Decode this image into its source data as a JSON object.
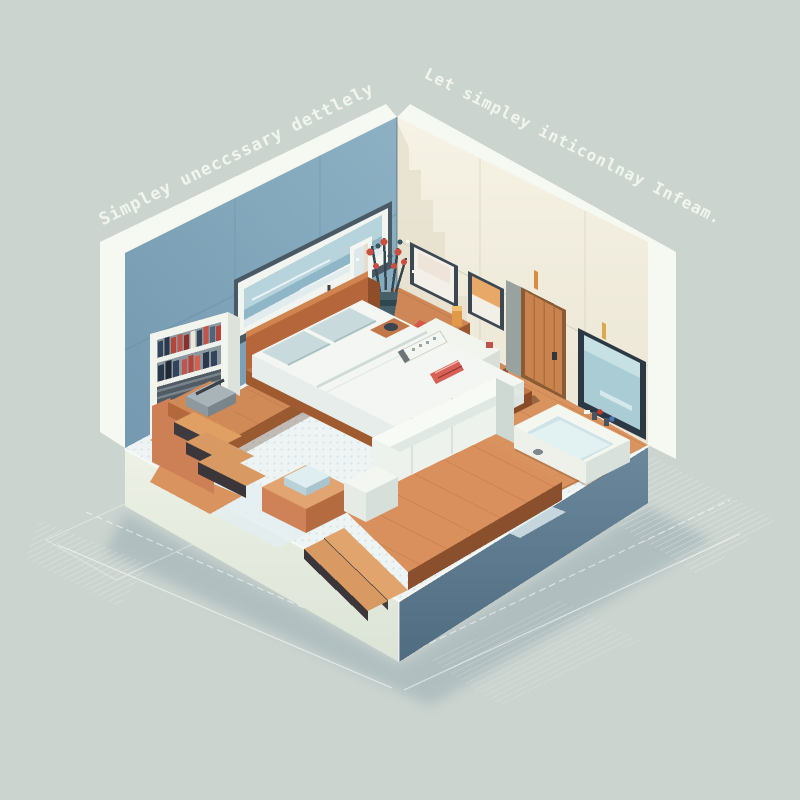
{
  "illustration": {
    "style": "isometric pixel-art bedroom diorama",
    "captions": {
      "left": "Simpley uneccssary dettlely",
      "right": "Let simpley inticonlnay Infeam."
    },
    "palette": {
      "background": "#ccd4cf",
      "left_wall": "#82a8bd",
      "right_wall": "#f3efe2",
      "wall_trim": "#f6f8f2",
      "floor_rug": "#eef3f4",
      "wood": "#d08a57",
      "wood_dark": "#9a5a31",
      "base_front": "#e9eee3",
      "base_side": "#5d7b90",
      "bed_linen": "#f3f6f2",
      "pillow": "#c8dadb",
      "accent_red": "#c4503e",
      "accent_orange": "#e0a46c",
      "tv_screen": "#a9ccd5",
      "caption_text": "#f4f7f0"
    },
    "objects": [
      "bed",
      "pillows",
      "bookshelf",
      "books",
      "stairs",
      "game-console",
      "wall-art",
      "mirror",
      "wall-lamp",
      "flower-vase",
      "runner-rug",
      "red-cushion",
      "console-bench",
      "bottle",
      "remote",
      "magazine",
      "door",
      "framed-prints",
      "tv",
      "bathtub",
      "ottoman",
      "sofa",
      "platform-steps"
    ]
  }
}
